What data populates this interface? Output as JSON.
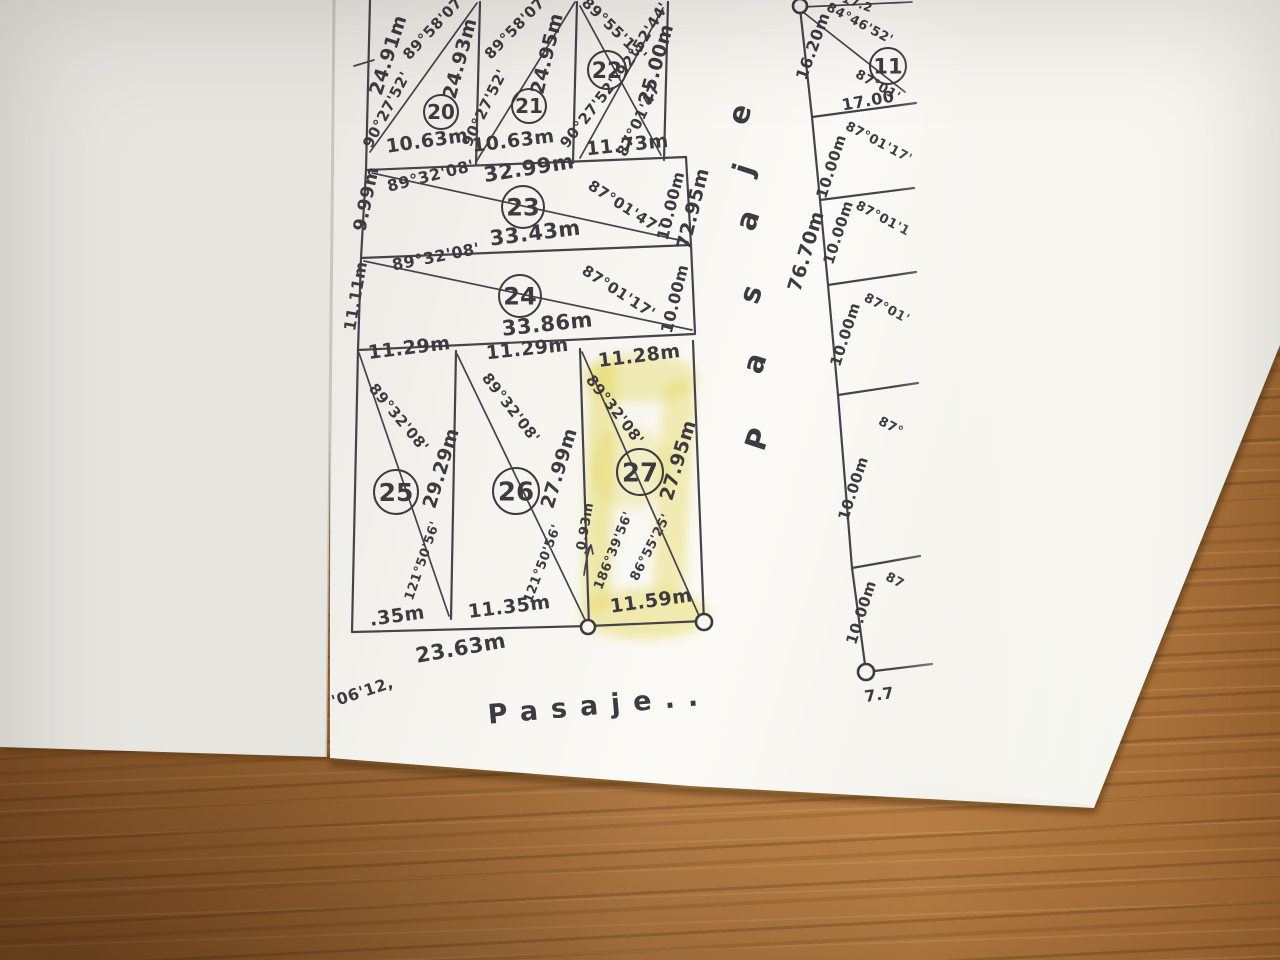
{
  "colors": {
    "ink": "#3c3b40",
    "paper": "#f6f5f0",
    "under_sheet": "#e7e5e0",
    "highlight": "#e3d44f",
    "wood": "#a97138"
  },
  "streets": {
    "vertical_street": "Pasaje",
    "bottom_street": "Pasaje..",
    "vertical_length_left": "72.95m",
    "vertical_length_right": "76.70m"
  },
  "highlighted_lot": "27",
  "lots": [
    {
      "n": "20",
      "x": 441,
      "y": 112,
      "r": 17
    },
    {
      "n": "21",
      "x": 529,
      "y": 106,
      "r": 17
    },
    {
      "n": "22",
      "x": 607,
      "y": 70,
      "r": 19
    },
    {
      "n": "23",
      "x": 523,
      "y": 207,
      "r": 21
    },
    {
      "n": "24",
      "x": 520,
      "y": 296,
      "r": 21
    },
    {
      "n": "25",
      "x": 396,
      "y": 492,
      "r": 22
    },
    {
      "n": "26",
      "x": 516,
      "y": 491,
      "r": 23
    },
    {
      "n": "27",
      "x": 640,
      "y": 472,
      "r": 23
    },
    {
      "n": "11",
      "x": 888,
      "y": 66,
      "r": 18
    }
  ],
  "monuments": [
    {
      "x": 800,
      "y": 6,
      "r": 7
    },
    {
      "x": 866,
      "y": 672,
      "r": 8
    },
    {
      "x": 588,
      "y": 627,
      "r": 7
    },
    {
      "x": 704,
      "y": 622,
      "r": 8
    }
  ],
  "annotations": [
    {
      "t": "24.91m",
      "x": 394,
      "y": 57,
      "r": -72,
      "s": 19
    },
    {
      "t": "90°27'52'",
      "x": 391,
      "y": 112,
      "r": -62,
      "s": 15
    },
    {
      "t": "89°58'07'",
      "x": 438,
      "y": 30,
      "r": -47,
      "s": 15
    },
    {
      "t": "24.93m",
      "x": 466,
      "y": 60,
      "r": -75,
      "s": 19
    },
    {
      "t": "10.63m",
      "x": 428,
      "y": 147,
      "r": -8,
      "s": 19
    },
    {
      "t": "90°27'52'",
      "x": 489,
      "y": 110,
      "r": -64,
      "s": 15
    },
    {
      "t": "89°58'07'",
      "x": 520,
      "y": 30,
      "r": -46,
      "s": 15
    },
    {
      "t": "24.95m",
      "x": 553,
      "y": 55,
      "r": -76,
      "s": 19
    },
    {
      "t": "10.63m",
      "x": 514,
      "y": 147,
      "r": -7,
      "s": 19
    },
    {
      "t": "89°55'13'",
      "x": 611,
      "y": 33,
      "r": 44,
      "s": 15
    },
    {
      "t": "92°52'44'",
      "x": 647,
      "y": 42,
      "r": -58,
      "s": 15
    },
    {
      "t": "25.00m",
      "x": 662,
      "y": 66,
      "r": -74,
      "s": 19
    },
    {
      "t": "90°27'52'",
      "x": 593,
      "y": 116,
      "r": -52,
      "s": 15
    },
    {
      "t": "87°01'47'",
      "x": 644,
      "y": 120,
      "r": -64,
      "s": 15
    },
    {
      "t": "11.73m",
      "x": 628,
      "y": 151,
      "r": -6,
      "s": 19
    },
    {
      "t": "9.99m",
      "x": 372,
      "y": 200,
      "r": -78,
      "s": 18
    },
    {
      "t": "89°32'08'",
      "x": 432,
      "y": 181,
      "r": -14,
      "s": 16
    },
    {
      "t": "32.99m",
      "x": 530,
      "y": 175,
      "r": -9,
      "s": 21
    },
    {
      "t": "87°01'47'",
      "x": 622,
      "y": 211,
      "r": 33,
      "s": 15
    },
    {
      "t": "10.00m",
      "x": 676,
      "y": 207,
      "r": -76,
      "s": 16
    },
    {
      "t": "33.43m",
      "x": 536,
      "y": 240,
      "r": -7,
      "s": 21
    },
    {
      "t": "89°32'08'",
      "x": 437,
      "y": 262,
      "r": -11,
      "s": 16
    },
    {
      "t": "11.11m",
      "x": 361,
      "y": 297,
      "r": -80,
      "s": 16
    },
    {
      "t": "87°01'17'",
      "x": 616,
      "y": 296,
      "r": 33,
      "s": 15
    },
    {
      "t": "10.00m",
      "x": 680,
      "y": 300,
      "r": -76,
      "s": 16
    },
    {
      "t": "33.86m",
      "x": 548,
      "y": 331,
      "r": -6,
      "s": 21
    },
    {
      "t": "11.29m",
      "x": 410,
      "y": 354,
      "r": -7,
      "s": 19
    },
    {
      "t": "11.29m",
      "x": 528,
      "y": 355,
      "r": -6,
      "s": 19
    },
    {
      "t": "11.28m",
      "x": 640,
      "y": 362,
      "r": -7,
      "s": 19
    },
    {
      "t": "89°32'08'",
      "x": 395,
      "y": 421,
      "r": 50,
      "s": 15
    },
    {
      "t": "89°32'08'",
      "x": 507,
      "y": 411,
      "r": 52,
      "s": 15
    },
    {
      "t": "89°32'08'",
      "x": 611,
      "y": 413,
      "r": 52,
      "s": 15
    },
    {
      "t": "29.29m",
      "x": 447,
      "y": 470,
      "r": -73,
      "s": 19
    },
    {
      "t": "27.99m",
      "x": 565,
      "y": 470,
      "r": -73,
      "s": 19
    },
    {
      "t": "27.95m",
      "x": 684,
      "y": 462,
      "r": -73,
      "s": 19
    },
    {
      "t": "121°50'56'",
      "x": 426,
      "y": 562,
      "r": -71,
      "s": 13
    },
    {
      "t": "121°50'56'",
      "x": 546,
      "y": 565,
      "r": -69,
      "s": 13
    },
    {
      "t": "0.93m",
      "x": 589,
      "y": 527,
      "r": -80,
      "s": 13
    },
    {
      "t": "186°39'56'",
      "x": 617,
      "y": 552,
      "r": -68,
      "s": 13
    },
    {
      "t": "86°55'25'",
      "x": 654,
      "y": 549,
      "r": -63,
      "s": 13
    },
    {
      "t": ".35m",
      "x": 398,
      "y": 622,
      "r": -8,
      "s": 19
    },
    {
      "t": "11.35m",
      "x": 510,
      "y": 613,
      "r": -7,
      "s": 19
    },
    {
      "t": "11.59m",
      "x": 652,
      "y": 607,
      "r": -8,
      "s": 19
    },
    {
      "t": "23.63m",
      "x": 462,
      "y": 655,
      "r": -10,
      "s": 21
    },
    {
      "t": "'06'12,",
      "x": 364,
      "y": 697,
      "r": -18,
      "s": 16
    },
    {
      "t": "Pasaje..",
      "x": 600,
      "y": 714,
      "r": -5,
      "s": 27,
      "ls": 13,
      "n": "street-label-bottom"
    },
    {
      "t": "72.95m",
      "x": 699,
      "y": 210,
      "r": -76,
      "s": 19
    },
    {
      "t": "P",
      "x": 767,
      "y": 442,
      "r": -72,
      "s": 29,
      "n": "street-letter"
    },
    {
      "t": "a",
      "x": 764,
      "y": 366,
      "r": -72,
      "s": 29,
      "n": "street-letter"
    },
    {
      "t": "s",
      "x": 760,
      "y": 297,
      "r": -72,
      "s": 29,
      "n": "street-letter"
    },
    {
      "t": "a",
      "x": 757,
      "y": 223,
      "r": -72,
      "s": 29,
      "n": "street-letter"
    },
    {
      "t": "j",
      "x": 753,
      "y": 172,
      "r": -72,
      "s": 29,
      "n": "street-letter"
    },
    {
      "t": "e",
      "x": 749,
      "y": 117,
      "r": -72,
      "s": 29,
      "n": "street-letter"
    },
    {
      "t": "76.70m",
      "x": 812,
      "y": 253,
      "r": -73,
      "s": 19
    },
    {
      "t": "16.20m",
      "x": 818,
      "y": 48,
      "r": -70,
      "s": 16
    },
    {
      "t": "84°46'52'",
      "x": 858,
      "y": 27,
      "r": 28,
      "s": 13
    },
    {
      "t": "17.2",
      "x": 856,
      "y": 7,
      "r": 20,
      "s": 12
    },
    {
      "t": "87°01'",
      "x": 876,
      "y": 89,
      "r": 30,
      "s": 13
    },
    {
      "t": "17.00",
      "x": 869,
      "y": 106,
      "r": -10,
      "s": 16
    },
    {
      "t": "87°01'17'",
      "x": 877,
      "y": 146,
      "r": 28,
      "s": 13
    },
    {
      "t": "10.00m",
      "x": 836,
      "y": 168,
      "r": -72,
      "s": 15
    },
    {
      "t": "87°01'1",
      "x": 881,
      "y": 222,
      "r": 28,
      "s": 13
    },
    {
      "t": "10.00m",
      "x": 843,
      "y": 234,
      "r": -72,
      "s": 15
    },
    {
      "t": "87°01'",
      "x": 885,
      "y": 312,
      "r": 28,
      "s": 13
    },
    {
      "t": "10.00m",
      "x": 850,
      "y": 336,
      "r": -72,
      "s": 15
    },
    {
      "t": "87°",
      "x": 889,
      "y": 430,
      "r": 28,
      "s": 13
    },
    {
      "t": "10.00m",
      "x": 858,
      "y": 490,
      "r": -72,
      "s": 15
    },
    {
      "t": "87",
      "x": 893,
      "y": 584,
      "r": 28,
      "s": 13
    },
    {
      "t": "10.00m",
      "x": 866,
      "y": 614,
      "r": -72,
      "s": 15
    },
    {
      "t": "7.7",
      "x": 880,
      "y": 700,
      "r": -8,
      "s": 16
    }
  ]
}
